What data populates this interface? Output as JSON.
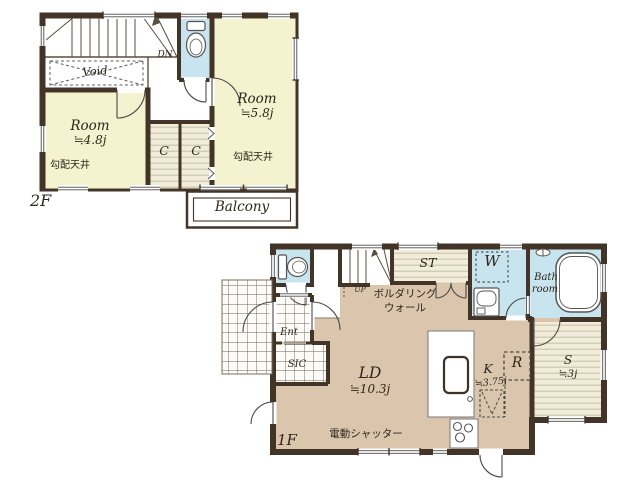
{
  "colors": {
    "wall": "#423528",
    "room_yellow": "#f5f2cf",
    "floor_tan": "#dbc5ac",
    "wet_blue": "#c8e4ef",
    "stripe_beige": "#f2edda"
  },
  "floor2": {
    "name": "2F",
    "rooms": {
      "left_name": "Room",
      "left_size": "≒4.8j",
      "left_ceiling": "勾配天井",
      "right_name": "Room",
      "right_size": "≒5.8j",
      "right_ceiling": "勾配天井",
      "closet_a": "C",
      "closet_b": "C",
      "void": "Void",
      "down": "DN",
      "balcony": "Balcony"
    }
  },
  "floor1": {
    "name": "1F",
    "rooms": {
      "ld_name": "LD",
      "ld_size": "≒10.3j",
      "k_name": "K",
      "k_size": "≒3.75j",
      "s_name": "S",
      "s_size": "≒3j",
      "st": "ST",
      "w": "W",
      "r": "R",
      "bath_1": "Bath",
      "bath_2": "room",
      "ent": "Ent",
      "sic": "SIC",
      "up": "UP",
      "bouldering_1": "ボルダリング",
      "bouldering_2": "ウォール",
      "shutter": "電動シャッター"
    }
  }
}
